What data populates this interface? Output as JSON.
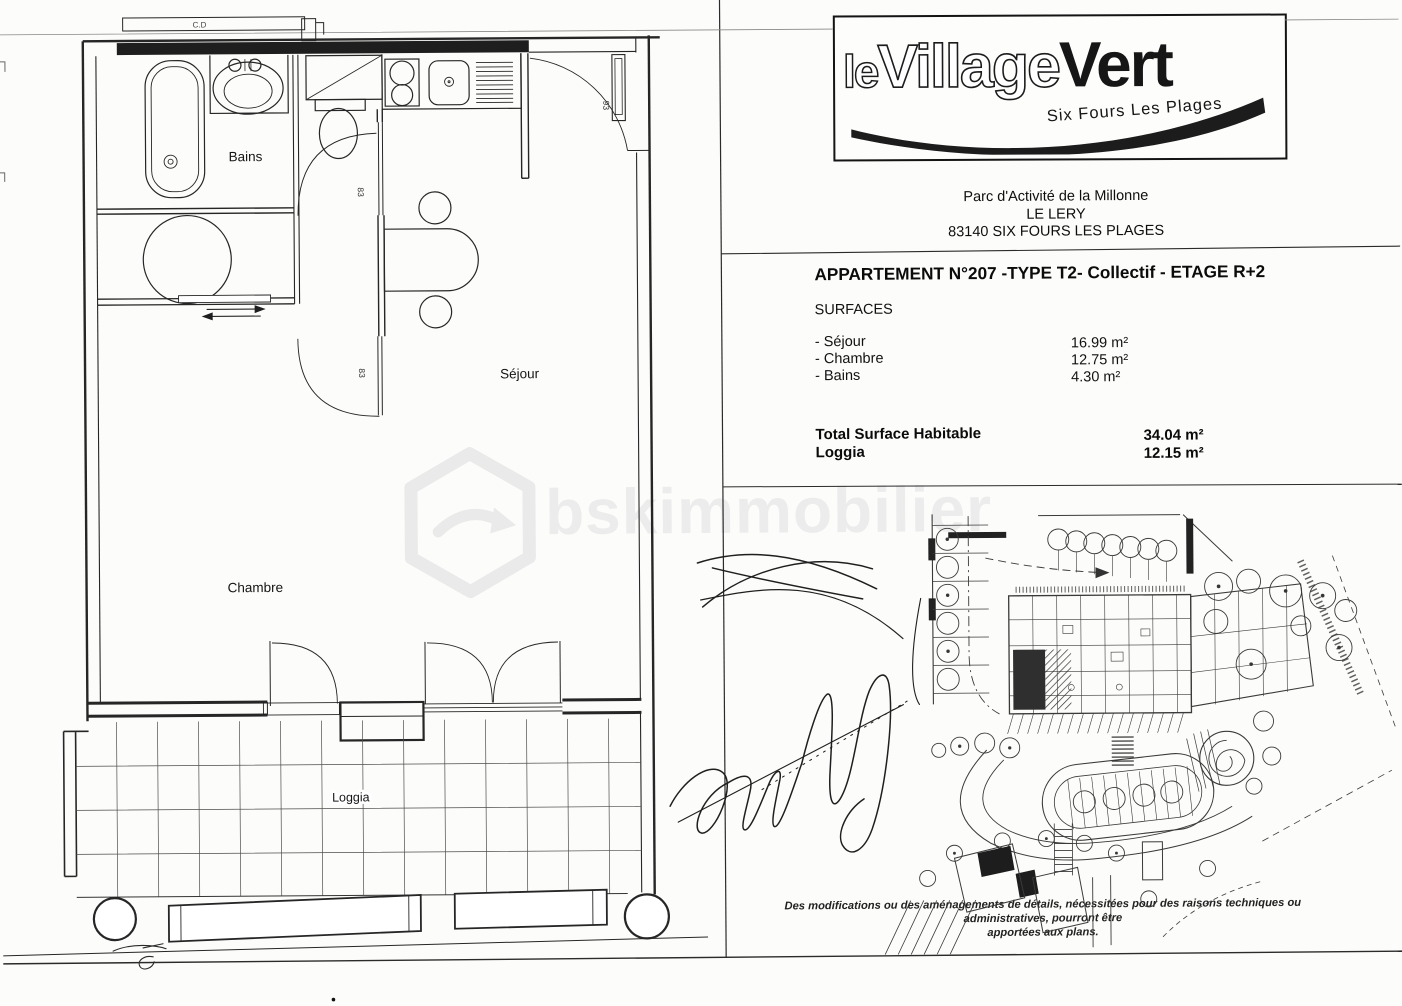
{
  "page": {
    "background": "#fcfcfa",
    "ink": "#1f1f1f"
  },
  "logo": {
    "prefix": "le",
    "middle": "Village",
    "suffix": "Vert",
    "tagline": "Six Fours Les Plages"
  },
  "address": {
    "line1": "Parc d'Activité de la Millonne",
    "line2": "LE LERY",
    "line3": "83140 SIX FOURS LES PLAGES"
  },
  "listing": {
    "title": "APPARTEMENT N°207 -TYPE T2- Collectif - ETAGE R+2",
    "surfaces_heading": "SURFACES",
    "surfaces": [
      {
        "label": "- Séjour",
        "value": "16.99 m²"
      },
      {
        "label": "- Chambre",
        "value": "12.75 m²"
      },
      {
        "label": "- Bains",
        "value": "4.30 m²"
      }
    ],
    "totals": [
      {
        "label": "Total Surface Habitable",
        "value": "34.04 m²"
      },
      {
        "label": "Loggia",
        "value": "12.15 m²"
      }
    ]
  },
  "floorplan": {
    "room_labels": {
      "bains": "Bains",
      "sejour": "Séjour",
      "chambre": "Chambre",
      "loggia": "Loggia"
    },
    "door_labels": {
      "interior_upper": "83",
      "interior_lower": "83",
      "entry": "93"
    },
    "ledge_label": "C.D"
  },
  "watermark": {
    "text": "bskimmobilier"
  },
  "footnote": {
    "line1": "Des modifications ou des aménagements de détails, nécessitées pour des raisons techniques ou administratives, pourront être",
    "line2": "apportées aux plans."
  }
}
